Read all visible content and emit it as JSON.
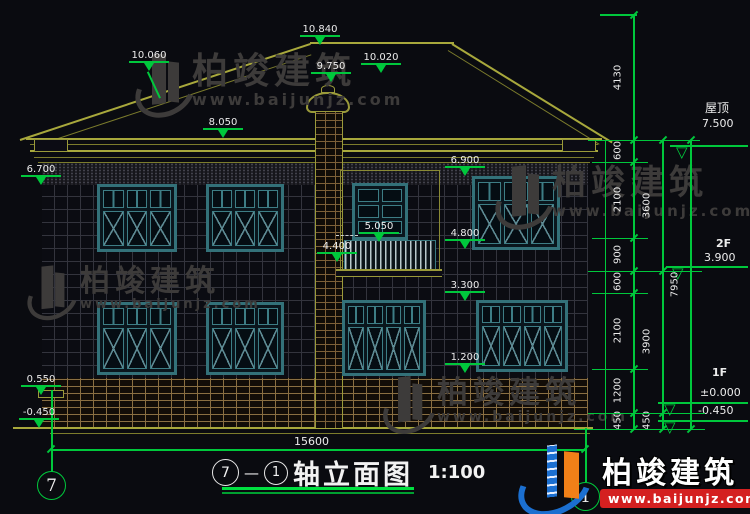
{
  "watermark": {
    "brand": "柏竣建筑",
    "url": "www.baijunjz.com"
  },
  "footer_brand": {
    "name": "柏竣建筑",
    "url": "www.baijunjz.com"
  },
  "title_block": {
    "axis_start": "7",
    "dash": "—",
    "axis_end": "1",
    "title": "轴立面图",
    "scale": "1:100"
  },
  "axis_bubbles": {
    "left": "7",
    "right": "1"
  },
  "overall_width": "15600",
  "elevation_annotations": [
    {
      "id": "a10840",
      "value": "10.840"
    },
    {
      "id": "a10060",
      "value": "10.060"
    },
    {
      "id": "a10020",
      "value": "10.020"
    },
    {
      "id": "a9750",
      "value": "9.750"
    },
    {
      "id": "a8050",
      "value": "8.050"
    },
    {
      "id": "a6900",
      "value": "6.900"
    },
    {
      "id": "a6700",
      "value": "6.700"
    },
    {
      "id": "a5050",
      "value": "5.050"
    },
    {
      "id": "a4800",
      "value": "4.800"
    },
    {
      "id": "a4400",
      "value": "4.400"
    },
    {
      "id": "a3300",
      "value": "3.300"
    },
    {
      "id": "a1200",
      "value": "1.200"
    },
    {
      "id": "a0550",
      "value": "0.550"
    },
    {
      "id": "am0450",
      "value": "-0.450"
    }
  ],
  "right_dims": {
    "chain_inner": [
      "4130",
      "600",
      "2100",
      "900",
      "600",
      "2100",
      "1200",
      "450"
    ],
    "chain_mid": [
      "3600",
      "3900",
      "450"
    ],
    "chain_outer": [
      "7950"
    ]
  },
  "levels": {
    "roof_name": "屋顶",
    "roof_value": "7.500",
    "f2_name": "2F",
    "f2_value": "3.900",
    "f1_name": "1F",
    "f1_zero": "±0.000",
    "f1_minus": "-0.450"
  },
  "colors": {
    "dim_green": "#00c83c",
    "line_yellow": "#9a9a3a",
    "brand_red": "#d42020",
    "brand_blue": "#1b6fd0",
    "brand_orange": "#f08018"
  }
}
